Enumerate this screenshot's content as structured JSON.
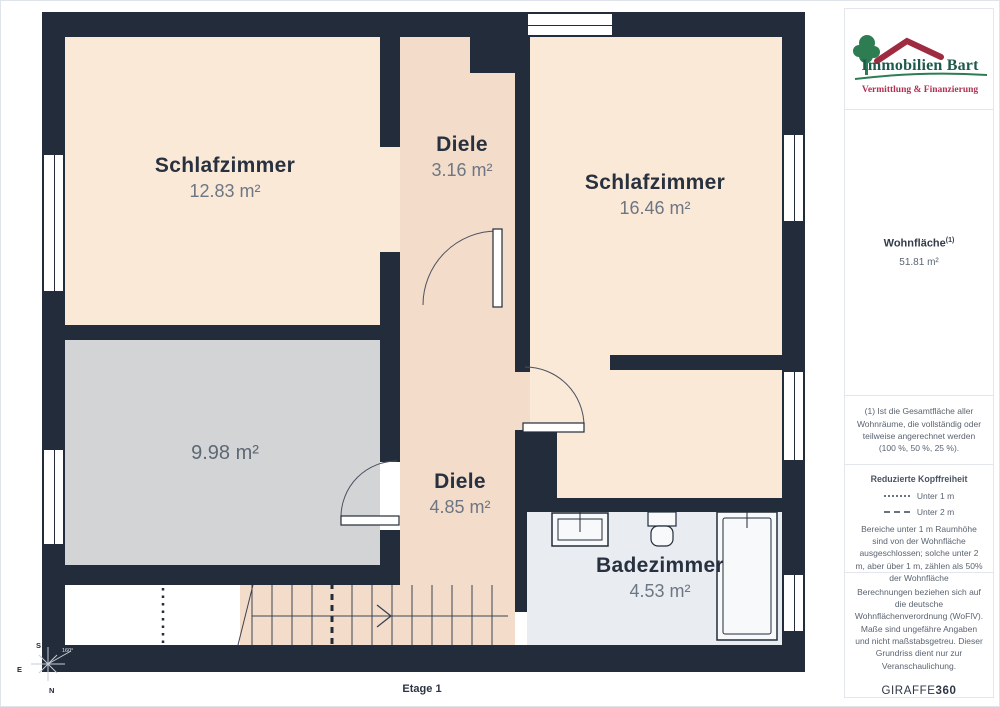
{
  "plan": {
    "floor_label": "Etage 1",
    "rooms": {
      "bedroom1": {
        "name": "Schlafzimmer",
        "area": "12.83 m²"
      },
      "hall1": {
        "name": "Diele",
        "area": "3.16 m²"
      },
      "bedroom2": {
        "name": "Schlafzimmer",
        "area": "16.46 m²"
      },
      "unnamed": {
        "area": "9.98 m²"
      },
      "hall2": {
        "name": "Diele",
        "area": "4.85 m²"
      },
      "bathroom": {
        "name": "Badezimmer",
        "area": "4.53 m²"
      }
    },
    "compass": {
      "south": "S",
      "east": "E",
      "north": "N",
      "rotation": "160°"
    },
    "colors": {
      "wall": "#222c3a",
      "room_peach": "#fbe9d8",
      "corridor_peach": "#f3dcc9",
      "gray_room": "#d3d4d6",
      "bathroom_blue": "#e9edf2"
    }
  },
  "sidebar": {
    "logo": {
      "company": "Immobilien Bart",
      "tagline": "Vermittlung & Finanzierung",
      "green": "#2e7d52",
      "red": "#b23052"
    },
    "wohnflaeche": {
      "label": "Wohnfläche",
      "sup": "(1)",
      "value": "51.81 m²"
    },
    "footnote": "(1) Ist die Gesamtfläche aller Wohnräume, die vollständig oder teilweise angerechnet werden (100 %, 50 %, 25 %).",
    "legend": {
      "title": "Reduzierte Kopffreiheit",
      "items": [
        {
          "label": "Unter 1 m"
        },
        {
          "label": "Unter 2 m"
        }
      ],
      "note": "Bereiche unter 1 m Raumhöhe sind von der Wohnfläche ausgeschlossen; solche unter 2 m, aber über 1 m, zählen als 50% der Wohnfläche"
    },
    "disclaimer": "Berechnungen beziehen sich auf die deutsche Wohnflächenverordnung (WoFlV). Maße sind ungefähre Angaben und nicht maßstabsgetreu. Dieser Grundriss dient nur zur Veranschaulichung.",
    "brand": {
      "name": "GIRAFFE",
      "suffix": "360"
    }
  }
}
